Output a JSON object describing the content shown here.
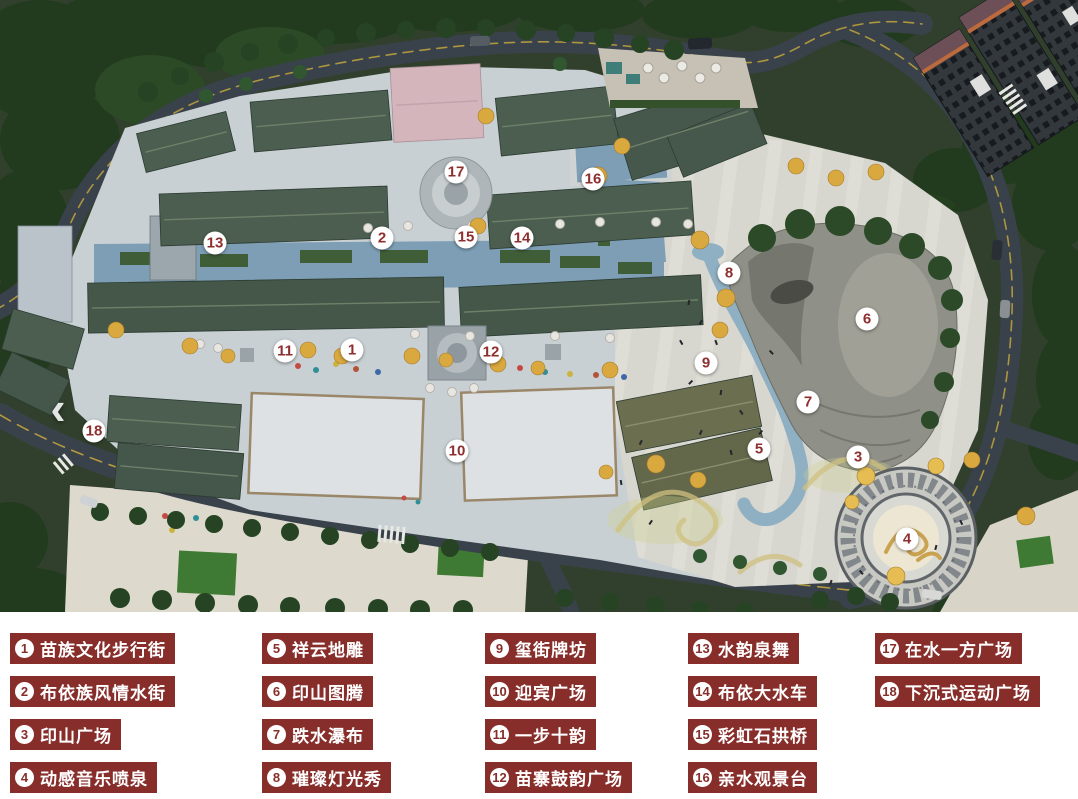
{
  "colors": {
    "legend_box": "#872e2b",
    "legend_text": "#ffffff",
    "legend_number_circle": "#ffffff",
    "legend_number_text": "#872e2b",
    "marker_circle": "#ffffff",
    "marker_number_text": "#8e2f2f"
  },
  "nav": {
    "prev_symbol": "‹"
  },
  "map": {
    "markers": [
      {
        "n": "1",
        "x": 352,
        "y": 350
      },
      {
        "n": "2",
        "x": 382,
        "y": 238
      },
      {
        "n": "3",
        "x": 858,
        "y": 457
      },
      {
        "n": "4",
        "x": 907,
        "y": 539
      },
      {
        "n": "5",
        "x": 759,
        "y": 449
      },
      {
        "n": "6",
        "x": 867,
        "y": 319
      },
      {
        "n": "7",
        "x": 808,
        "y": 402
      },
      {
        "n": "8",
        "x": 729,
        "y": 273
      },
      {
        "n": "9",
        "x": 706,
        "y": 363
      },
      {
        "n": "10",
        "x": 457,
        "y": 451
      },
      {
        "n": "11",
        "x": 285,
        "y": 351
      },
      {
        "n": "12",
        "x": 491,
        "y": 352
      },
      {
        "n": "13",
        "x": 215,
        "y": 243
      },
      {
        "n": "14",
        "x": 522,
        "y": 238
      },
      {
        "n": "15",
        "x": 466,
        "y": 237
      },
      {
        "n": "16",
        "x": 593,
        "y": 179
      },
      {
        "n": "17",
        "x": 456,
        "y": 172
      },
      {
        "n": "18",
        "x": 94,
        "y": 431
      }
    ]
  },
  "legend": {
    "columns": [
      [
        {
          "n": "1",
          "label": "苗族文化步行街"
        },
        {
          "n": "2",
          "label": "布依族风情水街"
        },
        {
          "n": "3",
          "label": "印山广场"
        },
        {
          "n": "4",
          "label": "动感音乐喷泉"
        }
      ],
      [
        {
          "n": "5",
          "label": "祥云地雕"
        },
        {
          "n": "6",
          "label": "印山图腾"
        },
        {
          "n": "7",
          "label": "跌水瀑布"
        },
        {
          "n": "8",
          "label": "璀璨灯光秀"
        }
      ],
      [
        {
          "n": "9",
          "label": "玺街牌坊"
        },
        {
          "n": "10",
          "label": "迎宾广场"
        },
        {
          "n": "11",
          "label": "一步十韵"
        },
        {
          "n": "12",
          "label": "苗寨鼓韵广场"
        }
      ],
      [
        {
          "n": "13",
          "label": "水韵泉舞"
        },
        {
          "n": "14",
          "label": "布依大水车"
        },
        {
          "n": "15",
          "label": "彩虹石拱桥"
        },
        {
          "n": "16",
          "label": "亲水观景台"
        }
      ],
      [
        {
          "n": "17",
          "label": "在水一方广场"
        },
        {
          "n": "18",
          "label": "下沉式运动广场"
        }
      ]
    ]
  }
}
